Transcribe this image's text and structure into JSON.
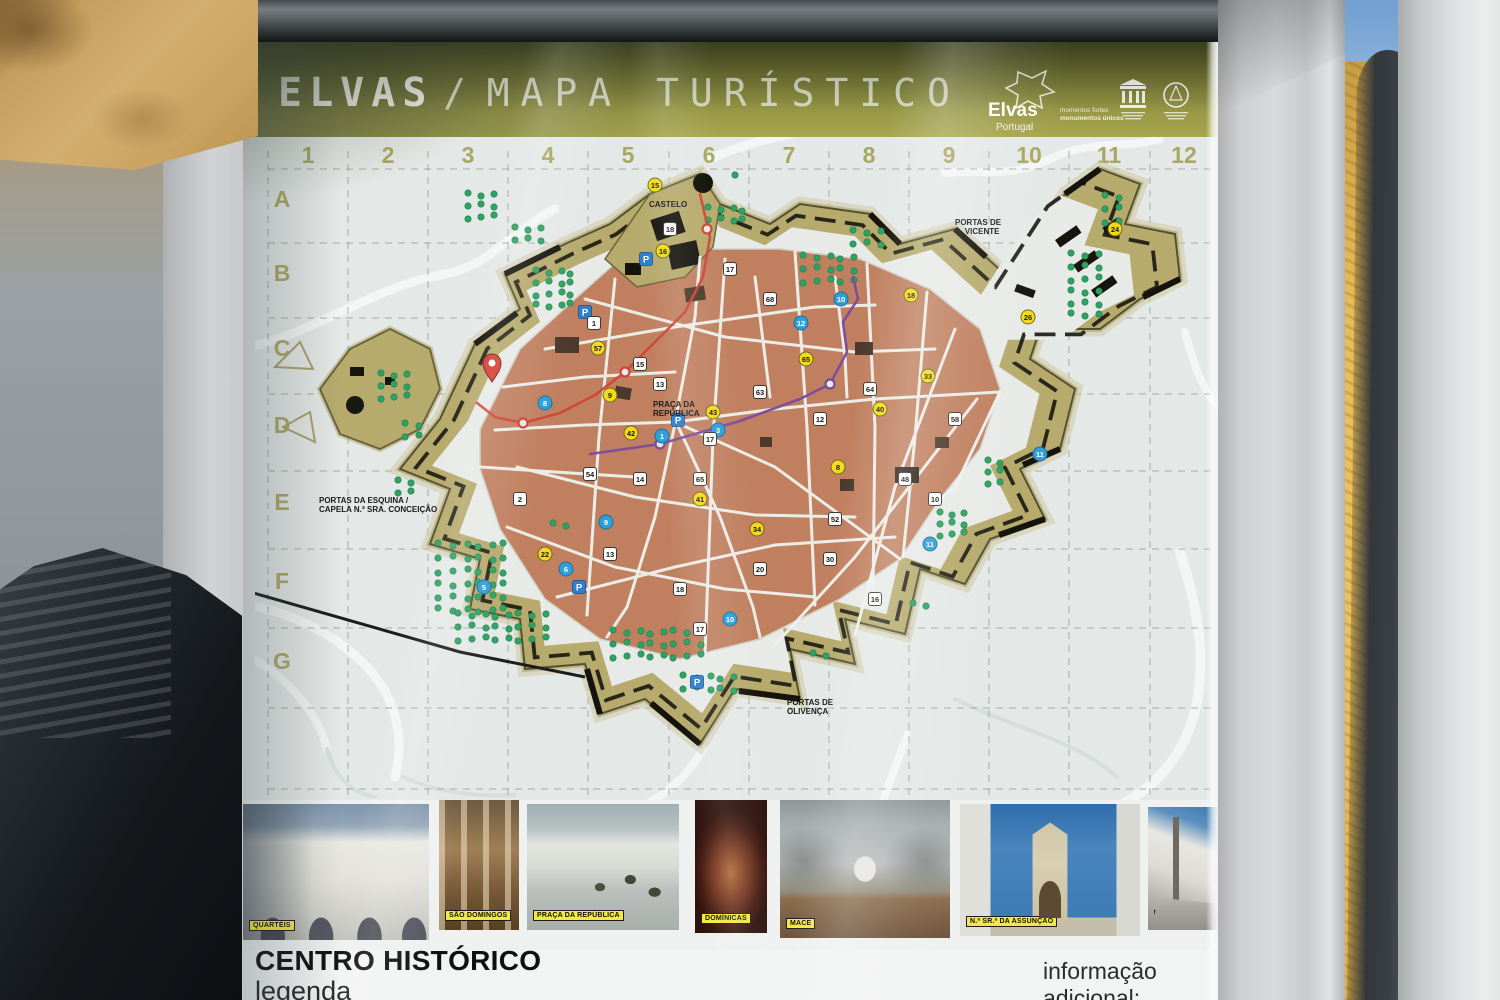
{
  "scene": {
    "description": "Photograph of an outdoor tourist map information sign",
    "location_title": "ELVAS / MAPA TURÍSTICO"
  },
  "sign": {
    "title": {
      "primary": "ELVAS",
      "separator": "/",
      "secondary": "MAPA TURÍSTICO"
    },
    "logos": {
      "elvas": {
        "name": "Elvas",
        "country": "Portugal",
        "tagline_line1": "momentos fortes",
        "tagline_line2": "monumentos únicos"
      },
      "unesco": {
        "icon": "unesco-temple-emblem"
      },
      "world_heritage": {
        "icon": "world-heritage-circle-emblem"
      }
    }
  },
  "map": {
    "grid": {
      "columns": [
        "1",
        "2",
        "3",
        "4",
        "5",
        "6",
        "7",
        "8",
        "9",
        "10",
        "11",
        "12"
      ],
      "rows": [
        "A",
        "B",
        "C",
        "D",
        "E",
        "F",
        "G"
      ]
    },
    "colors": {
      "wall": "#b6aa6c",
      "city": "#c08060",
      "trees": "#2fa263",
      "map_bg": "#e4e8e6",
      "route_red": "#cf4435",
      "route_purple": "#7b4a9e",
      "marker_yellow": "#f4d91c",
      "marker_blue": "#2f9fd8",
      "parking_blue": "#2f7fd0"
    },
    "labels": [
      {
        "lines": [
          "PORTAS DE",
          "S. VICENTE"
        ],
        "x": 700,
        "y": 88
      },
      {
        "lines": [
          "PORTAS DA ESQUINA /",
          "CAPELA N.ª SRA. CONCEIÇÃO"
        ],
        "x": 64,
        "y": 366
      },
      {
        "lines": [
          "PORTAS DE",
          "OLIVENÇA"
        ],
        "x": 532,
        "y": 568
      },
      {
        "lines": [
          "PRAÇA DA",
          "REPÚBLICA"
        ],
        "x": 398,
        "y": 270
      },
      {
        "lines": [
          "CASTELO"
        ],
        "x": 394,
        "y": 70
      }
    ],
    "routes": {
      "red": [
        [
          445,
          57
        ],
        [
          455,
          100
        ],
        [
          448,
          140
        ],
        [
          430,
          175
        ],
        [
          400,
          205
        ],
        [
          370,
          235
        ],
        [
          340,
          258
        ],
        [
          305,
          276
        ],
        [
          268,
          286
        ],
        [
          240,
          280
        ],
        [
          222,
          266
        ]
      ],
      "red_stops": [
        [
          452,
          92
        ],
        [
          370,
          235
        ],
        [
          268,
          286
        ]
      ],
      "purple": [
        [
          335,
          317
        ],
        [
          405,
          307
        ],
        [
          485,
          284
        ],
        [
          545,
          262
        ],
        [
          575,
          247
        ],
        [
          592,
          215
        ],
        [
          588,
          185
        ],
        [
          603,
          162
        ],
        [
          598,
          140
        ]
      ],
      "purple_stops": [
        [
          405,
          307
        ],
        [
          575,
          247
        ]
      ]
    },
    "markers": [
      {
        "t": "y",
        "x": 400,
        "y": 48,
        "n": "15"
      },
      {
        "t": "y",
        "x": 408,
        "y": 114,
        "n": "16"
      },
      {
        "t": "y",
        "x": 343,
        "y": 211,
        "n": "57"
      },
      {
        "t": "y",
        "x": 355,
        "y": 258,
        "n": "9"
      },
      {
        "t": "y",
        "x": 376,
        "y": 296,
        "n": "42"
      },
      {
        "t": "y",
        "x": 458,
        "y": 275,
        "n": "43"
      },
      {
        "t": "y",
        "x": 551,
        "y": 222,
        "n": "65"
      },
      {
        "t": "y",
        "x": 583,
        "y": 330,
        "n": "8"
      },
      {
        "t": "y",
        "x": 673,
        "y": 239,
        "n": "33"
      },
      {
        "t": "y",
        "x": 656,
        "y": 158,
        "n": "18"
      },
      {
        "t": "y",
        "x": 773,
        "y": 180,
        "n": "26"
      },
      {
        "t": "y",
        "x": 502,
        "y": 392,
        "n": "34"
      },
      {
        "t": "y",
        "x": 290,
        "y": 417,
        "n": "22"
      },
      {
        "t": "y",
        "x": 445,
        "y": 362,
        "n": "41"
      },
      {
        "t": "y",
        "x": 625,
        "y": 272,
        "n": "40"
      },
      {
        "t": "y",
        "x": 860,
        "y": 92,
        "n": "24"
      },
      {
        "t": "b",
        "x": 407,
        "y": 299,
        "n": "1"
      },
      {
        "t": "b",
        "x": 463,
        "y": 293,
        "n": "3"
      },
      {
        "t": "b",
        "x": 290,
        "y": 266,
        "n": "8"
      },
      {
        "t": "b",
        "x": 586,
        "y": 162,
        "n": "10"
      },
      {
        "t": "b",
        "x": 785,
        "y": 317,
        "n": "11"
      },
      {
        "t": "b",
        "x": 351,
        "y": 385,
        "n": "9"
      },
      {
        "t": "b",
        "x": 229,
        "y": 450,
        "n": "5"
      },
      {
        "t": "b",
        "x": 475,
        "y": 482,
        "n": "10"
      },
      {
        "t": "b",
        "x": 675,
        "y": 407,
        "n": "11"
      },
      {
        "t": "b",
        "x": 546,
        "y": 186,
        "n": "12"
      },
      {
        "t": "b",
        "x": 311,
        "y": 432,
        "n": "6"
      },
      {
        "t": "w",
        "x": 339,
        "y": 186,
        "n": "1"
      },
      {
        "t": "w",
        "x": 385,
        "y": 227,
        "n": "15"
      },
      {
        "t": "w",
        "x": 405,
        "y": 247,
        "n": "13"
      },
      {
        "t": "w",
        "x": 455,
        "y": 302,
        "n": "17"
      },
      {
        "t": "w",
        "x": 505,
        "y": 255,
        "n": "63"
      },
      {
        "t": "w",
        "x": 565,
        "y": 282,
        "n": "12"
      },
      {
        "t": "w",
        "x": 615,
        "y": 252,
        "n": "64"
      },
      {
        "t": "w",
        "x": 385,
        "y": 342,
        "n": "14"
      },
      {
        "t": "w",
        "x": 445,
        "y": 342,
        "n": "65"
      },
      {
        "t": "w",
        "x": 335,
        "y": 337,
        "n": "54"
      },
      {
        "t": "w",
        "x": 580,
        "y": 382,
        "n": "52"
      },
      {
        "t": "w",
        "x": 650,
        "y": 342,
        "n": "48"
      },
      {
        "t": "w",
        "x": 700,
        "y": 282,
        "n": "58"
      },
      {
        "t": "w",
        "x": 265,
        "y": 362,
        "n": "2"
      },
      {
        "t": "w",
        "x": 355,
        "y": 417,
        "n": "13"
      },
      {
        "t": "w",
        "x": 425,
        "y": 452,
        "n": "18"
      },
      {
        "t": "w",
        "x": 505,
        "y": 432,
        "n": "20"
      },
      {
        "t": "w",
        "x": 575,
        "y": 422,
        "n": "30"
      },
      {
        "t": "w",
        "x": 445,
        "y": 492,
        "n": "17"
      },
      {
        "t": "w",
        "x": 515,
        "y": 162,
        "n": "68"
      },
      {
        "t": "w",
        "x": 475,
        "y": 132,
        "n": "17"
      },
      {
        "t": "w",
        "x": 415,
        "y": 92,
        "n": "18"
      },
      {
        "t": "w",
        "x": 620,
        "y": 462,
        "n": "16"
      },
      {
        "t": "w",
        "x": 680,
        "y": 362,
        "n": "10"
      }
    ],
    "parking": [
      [
        391,
        122
      ],
      [
        423,
        283
      ],
      [
        324,
        450
      ],
      [
        442,
        545
      ],
      [
        330,
        175
      ]
    ],
    "you_are_here": {
      "x": 237,
      "y": 245
    },
    "tree_clusters": [
      {
        "x": 185,
        "y": 408,
        "c": 6,
        "r": 6,
        "s": 13
      },
      {
        "x": 205,
        "y": 478,
        "c": 8,
        "r": 3,
        "s": 12
      },
      {
        "x": 360,
        "y": 495,
        "c": 8,
        "r": 3,
        "s": 12
      },
      {
        "x": 283,
        "y": 135,
        "c": 4,
        "r": 4,
        "s": 11
      },
      {
        "x": 215,
        "y": 58,
        "c": 3,
        "r": 3,
        "s": 11
      },
      {
        "x": 818,
        "y": 118,
        "c": 3,
        "r": 6,
        "s": 12
      },
      {
        "x": 852,
        "y": 60,
        "c": 2,
        "r": 3,
        "s": 12
      },
      {
        "x": 128,
        "y": 238,
        "c": 3,
        "r": 3,
        "s": 11
      },
      {
        "x": 152,
        "y": 288,
        "c": 2,
        "r": 2,
        "s": 12
      },
      {
        "x": 687,
        "y": 377,
        "c": 3,
        "r": 3,
        "s": 10
      },
      {
        "x": 455,
        "y": 72,
        "c": 4,
        "r": 2,
        "s": 11
      },
      {
        "x": 735,
        "y": 325,
        "c": 2,
        "r": 3,
        "s": 10
      },
      {
        "x": 262,
        "y": 92,
        "c": 3,
        "r": 2,
        "s": 11
      },
      {
        "x": 550,
        "y": 120,
        "c": 5,
        "r": 3,
        "s": 12
      },
      {
        "x": 600,
        "y": 95,
        "c": 3,
        "r": 2,
        "s": 12
      },
      {
        "x": 430,
        "y": 540,
        "c": 5,
        "r": 2,
        "s": 12
      },
      {
        "x": 145,
        "y": 345,
        "c": 2,
        "r": 2,
        "s": 11
      },
      {
        "x": 482,
        "y": 40,
        "c": 1,
        "r": 1,
        "s": 10
      },
      {
        "x": 300,
        "y": 388,
        "c": 2,
        "r": 1,
        "s": 11
      },
      {
        "x": 660,
        "y": 468,
        "c": 2,
        "r": 1,
        "s": 11
      },
      {
        "x": 560,
        "y": 518,
        "c": 2,
        "r": 1,
        "s": 11
      }
    ]
  },
  "photos": [
    {
      "label": "QUARTÉIS",
      "style": "p-quarteis",
      "left": 0,
      "top": 4,
      "width": 186,
      "height": 136
    },
    {
      "label": "SÃO DOMINGOS",
      "style": "p-domingos",
      "left": 196,
      "top": 0,
      "width": 80,
      "height": 130
    },
    {
      "label": "PRAÇA DA REPÚBLICA",
      "style": "p-praca",
      "left": 284,
      "top": 4,
      "width": 152,
      "height": 126
    },
    {
      "label": "DOMÍNICAS",
      "style": "p-dominicas",
      "left": 452,
      "top": 0,
      "width": 72,
      "height": 133
    },
    {
      "label": "MACE",
      "style": "p-mace",
      "left": 537,
      "top": 0,
      "width": 170,
      "height": 138
    },
    {
      "label": "N.ª SR.ª DA ASSUNÇÃO",
      "style": "p-assuncao",
      "left": 717,
      "top": 4,
      "width": 180,
      "height": 132
    },
    {
      "label": "PELOURINHO",
      "style": "p-pelourinho",
      "left": 905,
      "top": 7,
      "width": 70,
      "height": 123
    }
  ],
  "footer": {
    "heading": "CENTRO HISTÓRICO",
    "subheading": "legenda",
    "right_note": "informação adicional:"
  }
}
